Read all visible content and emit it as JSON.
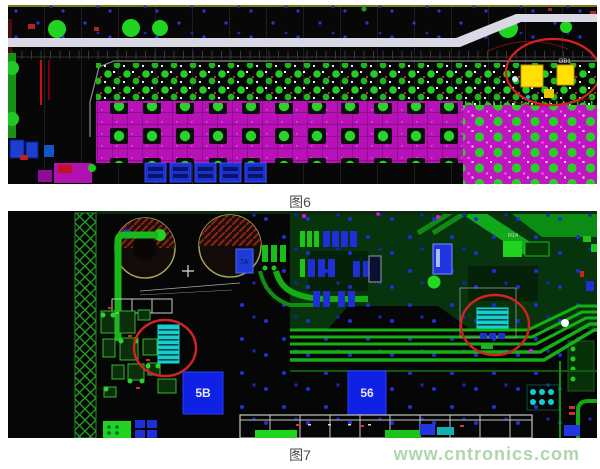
{
  "figures": [
    {
      "id": "fig6",
      "caption": "图6",
      "labels": {
        "component": "DB1"
      }
    },
    {
      "id": "fig7",
      "caption": "图7",
      "labels": {
        "chip_a": "5B",
        "chip_b": "56",
        "small_ic": "7A",
        "ref_des": "R14"
      }
    }
  ],
  "watermark": {
    "text": "www.cntronics.com"
  },
  "colors": {
    "pcb_trace_green": "#17b817",
    "pad_green": "#24d424",
    "copper_magenta": "#c215c2",
    "annotation_red": "#d42222",
    "component_blue": "#1021e6",
    "component_yellow": "#ffe000",
    "silkscreen_band": "#d9d9e6",
    "teal_component": "#17cfcf",
    "watermark_green": "#9fcf9f",
    "caption_gray": "#4a4a4a"
  }
}
